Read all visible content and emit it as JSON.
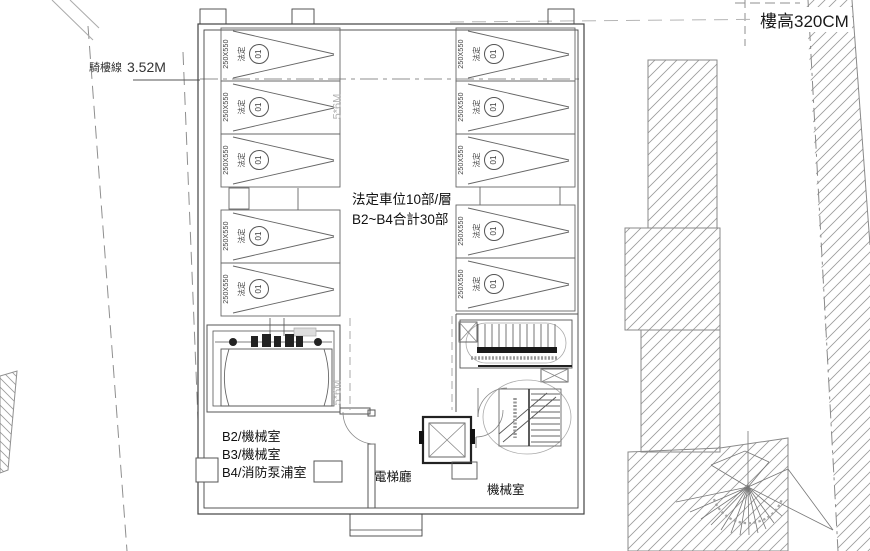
{
  "annotations": {
    "floor_height": "樓高320CM",
    "arcade_line_label": "騎樓線",
    "arcade_line_dim": "3.52M",
    "center_note_line1": "法定車位10部/層",
    "center_note_line2": "B2~B4合計30部",
    "room_b2": "B2/機械室",
    "room_b3": "B3/機械室",
    "room_b4": "B4/消防泵浦室",
    "elevator_hall": "電梯廳",
    "machine_room": "機械室",
    "aisle_dim": "5*6M"
  },
  "stalls": [
    {
      "size": "250X550",
      "type": "法定",
      "number": "01"
    },
    {
      "size": "250X550",
      "type": "法定",
      "number": "01"
    },
    {
      "size": "250X550",
      "type": "法定",
      "number": "01"
    },
    {
      "size": "250X550",
      "type": "法定",
      "number": "01"
    },
    {
      "size": "250X550",
      "type": "法定",
      "number": "01"
    },
    {
      "size": "250X550",
      "type": "法定",
      "number": "01"
    },
    {
      "size": "250X550",
      "type": "法定",
      "number": "01"
    },
    {
      "size": "250X550",
      "type": "法定",
      "number": "01"
    },
    {
      "size": "250X550",
      "type": "法定",
      "number": "01"
    },
    {
      "size": "250X550",
      "type": "法定",
      "number": "01"
    }
  ],
  "colors": {
    "line": "#555555",
    "light_line": "#999999",
    "dash": "#aaaaaa",
    "text": "#111111",
    "gray_text": "#b3b3b3",
    "background": "#ffffff"
  }
}
